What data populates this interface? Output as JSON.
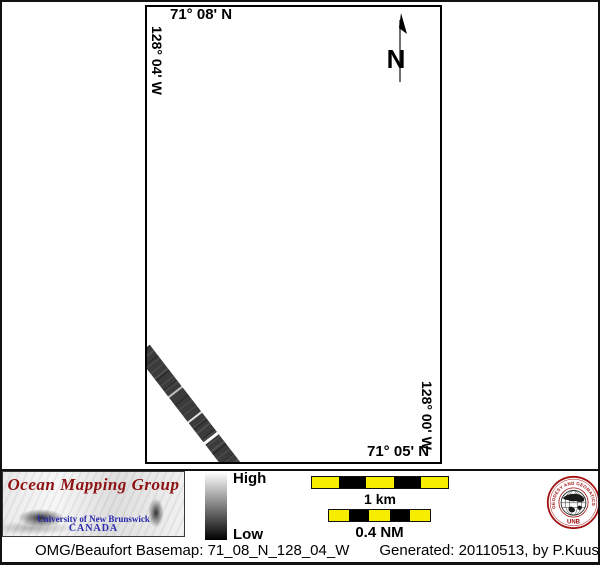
{
  "map": {
    "top_label": "71° 08' N",
    "left_label": "128° 04' W",
    "right_label": "128° 00' W",
    "bottom_label": "71° 05' N",
    "north_arrow_label": "N"
  },
  "colorbar": {
    "high_label": "High",
    "low_label": "Low",
    "top_color": "#ffffff",
    "bottom_color": "#000000"
  },
  "scalebars": [
    {
      "label": "1 km",
      "segments": [
        "#f6ed00",
        "#000000",
        "#f6ed00",
        "#000000",
        "#f6ed00"
      ]
    },
    {
      "label": "0.4 NM",
      "segments": [
        "#f6ed00",
        "#000000",
        "#f6ed00",
        "#000000",
        "#f6ed00"
      ]
    }
  ],
  "logo": {
    "title": "Ocean Mapping Group",
    "subtitle": "University of New Brunswick",
    "country": "CANADA",
    "title_color": "#8e1212",
    "text_color": "#2929b0"
  },
  "seal": {
    "ring_text": "GEODESY AND GEOMATICS ENGINEERING",
    "bottom_text": "UNB",
    "color": "#a01010"
  },
  "footer": {
    "basemap_text": "OMG/Beaufort Basemap: 71_08_N_128_04_W",
    "generated_text": "Generated: 20110513, by P.Kuus"
  }
}
